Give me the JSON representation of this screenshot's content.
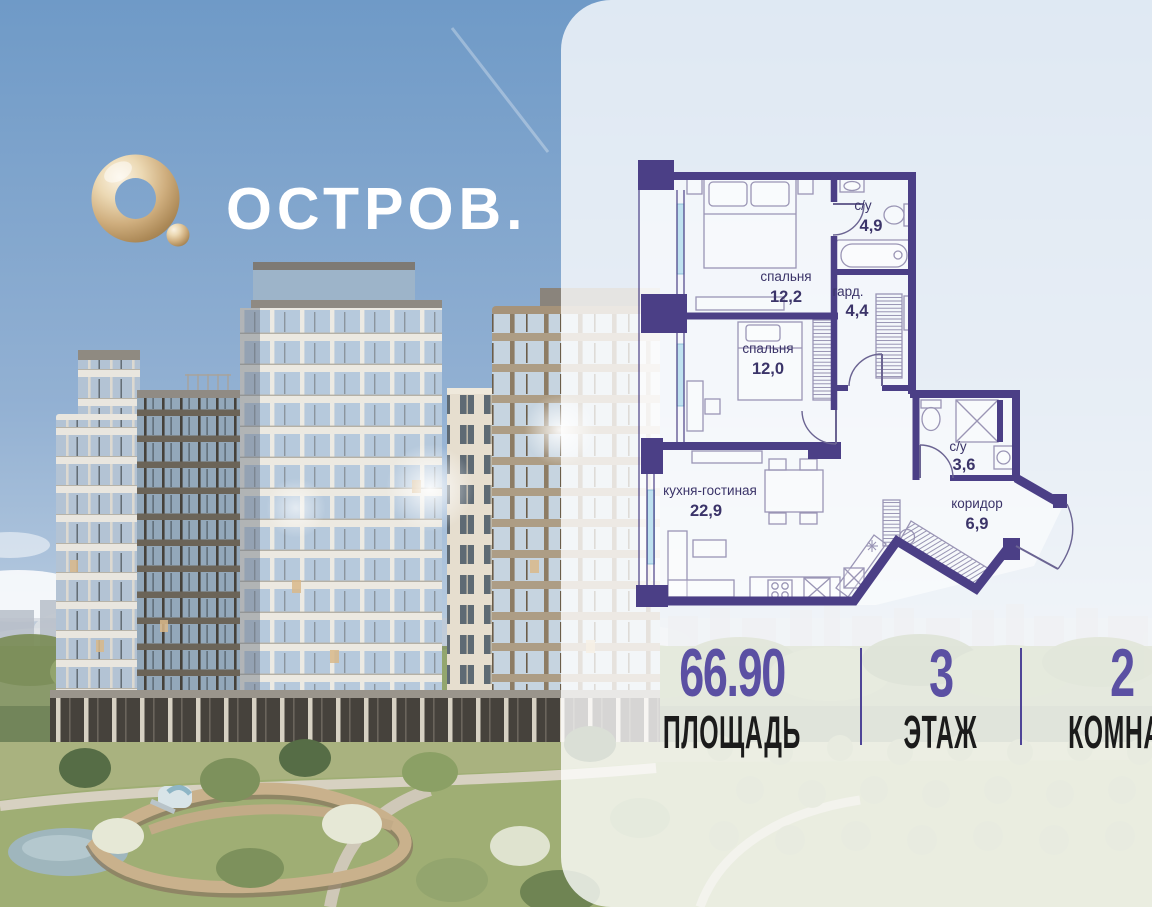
{
  "brand": {
    "wordmark": "ОСТРОВ."
  },
  "floorplan": {
    "rooms": [
      {
        "name": "спальня",
        "area": "12,2"
      },
      {
        "name": "с/у",
        "area": "4,9"
      },
      {
        "name": "гард.",
        "area": "4,4"
      },
      {
        "name": "спальня",
        "area": "12,0"
      },
      {
        "name": "кухня-гостиная",
        "area": "22,9"
      },
      {
        "name": "с/у",
        "area": "3,6"
      },
      {
        "name": "коридор",
        "area": "6,9"
      }
    ]
  },
  "stats": {
    "items": [
      {
        "value": "66.90",
        "label": "ПЛОЩАДЬ"
      },
      {
        "value": "3",
        "label": "ЭТАЖ"
      },
      {
        "value": "2",
        "label": "КОМНАТ"
      }
    ]
  },
  "colors": {
    "accent_purple": "#5b50a3",
    "plan_wall": "#4b3f86",
    "logo_gold": "#d8b988",
    "panel": "rgba(255,255,255,0.78)",
    "sky_top": "#6f9ac7"
  }
}
